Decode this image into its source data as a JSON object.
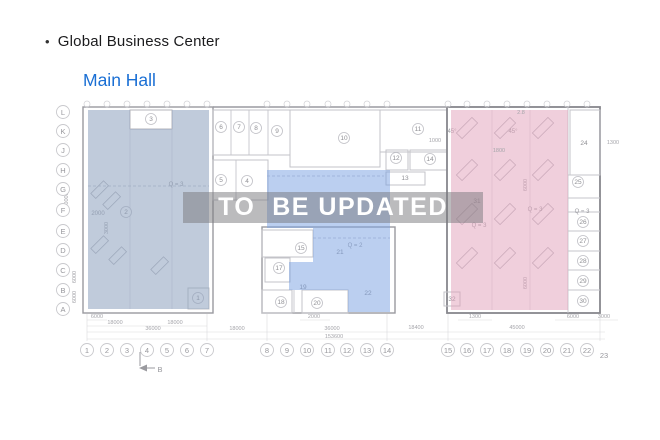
{
  "header": {
    "bullet": "•",
    "title": "Global Business Center"
  },
  "subtitle": "Main Hall",
  "watermark": {
    "text": "TO  BE UPDATED"
  },
  "colors": {
    "subtitle": "#1a6fd4",
    "left_zone": "rgba(140,160,190,0.55)",
    "middle_zone": "rgba(120,160,225,0.5)",
    "right_zone": "rgba(225,160,185,0.5)",
    "watermark_band": "rgba(119,119,124,0.5)",
    "watermark_text": "#ffffff"
  },
  "plan": {
    "row_labels": [
      [
        "L",
        112
      ],
      [
        "K",
        131
      ],
      [
        "J",
        150
      ],
      [
        "H",
        170
      ],
      [
        "G",
        189
      ],
      [
        "F",
        210
      ],
      [
        "E",
        231
      ],
      [
        "D",
        250
      ],
      [
        "C",
        270
      ],
      [
        "B",
        290
      ],
      [
        "A",
        309
      ]
    ],
    "col_labels": [
      [
        "1",
        87
      ],
      [
        "2",
        107
      ],
      [
        "3",
        127
      ],
      [
        "4",
        147
      ],
      [
        "5",
        167
      ],
      [
        "6",
        187
      ],
      [
        "7",
        207
      ],
      [
        "8",
        267
      ],
      [
        "9",
        287
      ],
      [
        "10",
        307
      ],
      [
        "11",
        328
      ],
      [
        "12",
        347
      ],
      [
        "13",
        367
      ],
      [
        "14",
        387
      ],
      [
        "15",
        448
      ],
      [
        "16",
        467
      ],
      [
        "17",
        487
      ],
      [
        "18",
        507
      ],
      [
        "19",
        527
      ],
      [
        "20",
        547
      ],
      [
        "21",
        567
      ],
      [
        "22",
        587
      ]
    ],
    "col_label_23": {
      "label": "23",
      "x": 604,
      "y": 355
    },
    "rooms_circled": [
      [
        "1",
        198,
        298
      ],
      [
        "2",
        126,
        212
      ],
      [
        "3",
        151,
        119
      ],
      [
        "4",
        247,
        181
      ],
      [
        "5",
        221,
        180
      ],
      [
        "6",
        221,
        127
      ],
      [
        "7",
        239,
        127
      ],
      [
        "8",
        256,
        128
      ],
      [
        "9",
        277,
        131
      ],
      [
        "10",
        344,
        138
      ],
      [
        "11",
        418,
        129
      ],
      [
        "12",
        396,
        158
      ],
      [
        "14",
        430,
        159
      ],
      [
        "15",
        301,
        248
      ],
      [
        "17",
        279,
        268
      ],
      [
        "18",
        281,
        302
      ],
      [
        "20",
        317,
        303
      ],
      [
        "25",
        578,
        182
      ],
      [
        "26",
        583,
        222
      ],
      [
        "27",
        583,
        241
      ],
      [
        "28",
        583,
        261
      ],
      [
        "29",
        583,
        281
      ],
      [
        "30",
        583,
        301
      ]
    ],
    "rooms_plain": [
      [
        "13",
        405,
        178
      ],
      [
        "19",
        303,
        287
      ],
      [
        "21",
        340,
        252
      ],
      [
        "22",
        368,
        293
      ],
      [
        "24",
        584,
        143
      ],
      [
        "31",
        477,
        201
      ],
      [
        "32",
        452,
        299
      ]
    ],
    "notes": [
      [
        "Q = 3",
        176,
        184
      ],
      [
        "Q = 2",
        355,
        245
      ],
      [
        "Q = 3",
        479,
        225
      ],
      [
        "Q = 3",
        535,
        209
      ],
      [
        "Q = 3",
        582,
        211
      ],
      [
        "45°",
        452,
        131
      ],
      [
        "45°",
        513,
        131
      ],
      [
        "2000",
        98,
        213
      ]
    ],
    "dims_h": [
      [
        "6000",
        97,
        318
      ],
      [
        "18000",
        115,
        324
      ],
      [
        "18000",
        175,
        324
      ],
      [
        "36000",
        153,
        330
      ],
      [
        "18000",
        237,
        330
      ],
      [
        "36000",
        332,
        330
      ],
      [
        "153600",
        334,
        338
      ],
      [
        "2000",
        314,
        318
      ],
      [
        "1300",
        475,
        318
      ],
      [
        "6000",
        573,
        318
      ],
      [
        "3000",
        604,
        318
      ],
      [
        "18400",
        416,
        329
      ],
      [
        "45000",
        517,
        329
      ],
      [
        "1000",
        435,
        142
      ],
      [
        "1800",
        499,
        152
      ],
      [
        "2.8",
        521,
        114
      ],
      [
        "1300",
        613,
        144
      ]
    ],
    "dims_v": [
      [
        "60000",
        68,
        200
      ],
      [
        "6000",
        76,
        277
      ],
      [
        "6000",
        76,
        297
      ],
      [
        "3000",
        108,
        228
      ],
      [
        "6000",
        527,
        185
      ],
      [
        "6000",
        527,
        283
      ]
    ],
    "section_marker": "B"
  }
}
